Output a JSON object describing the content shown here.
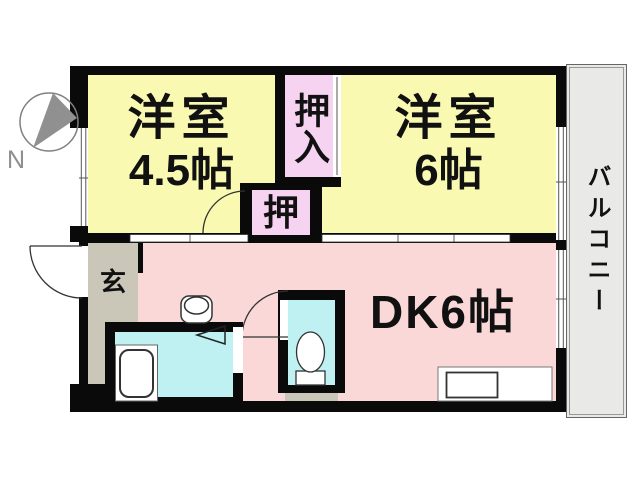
{
  "compass": {
    "label": "N"
  },
  "rooms": {
    "western_room_1": {
      "name": "洋室",
      "size": "4.5帖"
    },
    "western_room_2": {
      "name": "洋室",
      "size": "6帖"
    },
    "dining_kitchen": {
      "label": "DK6帖"
    },
    "closet_oshiire": {
      "label": "押入"
    },
    "closet_oshi": {
      "label": "押"
    },
    "entrance": {
      "label": "玄"
    },
    "balcony": {
      "label": "バルコニー"
    }
  },
  "fixtures": [
    "bathtub",
    "toilet",
    "washbasin",
    "kitchen-sink",
    "folding-door-marker"
  ],
  "colors": {
    "wall": "#0a0a0a",
    "western_room": "#faf9b1",
    "dining_kitchen": "#fad8d8",
    "closet": "#f5d3f1",
    "bath_toilet": "#bff0f2",
    "entrance": "#cbc7b8",
    "balcony": "#e9e9e7",
    "compass_gray": "#8f8f8f"
  }
}
